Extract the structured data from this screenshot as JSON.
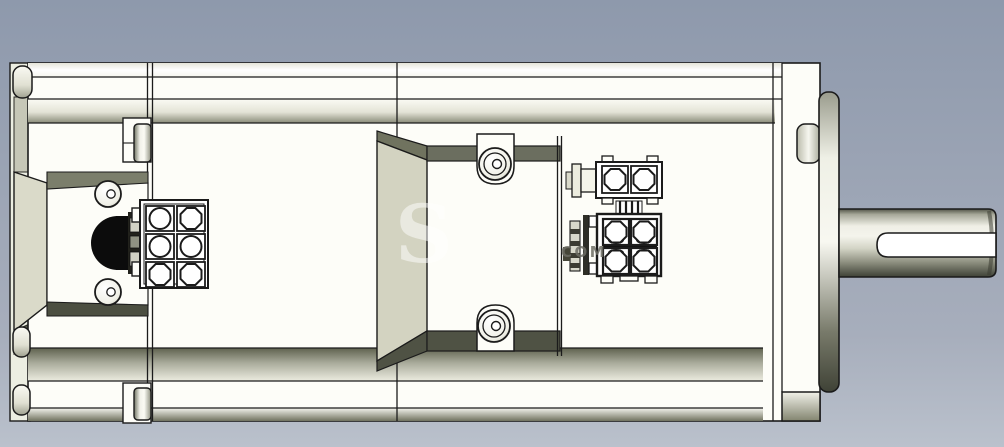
{
  "scene": {
    "kind": "cad-shaded-side-view",
    "subject": "electric servo motor with connectors and keyed output shaft"
  },
  "watermark": {
    "fragment_s": "S",
    "fragment_com": "COM"
  },
  "palette": {
    "background_top": "#8e99ac",
    "background_bottom": "#b9c0cb",
    "body_white": "#fdfdf8",
    "rail_shadow": "#8b8d7b",
    "deep_shadow": "#53564a",
    "recess_panel_beige": "#d3d3c1",
    "outline": "#1b1b1b",
    "grommet_black": "#0c0c0c"
  },
  "parts": [
    "motor-housing",
    "front-bracket-panel",
    "power-connector-6pin",
    "cable-grommet",
    "signal-connector-2pin",
    "signal-connector-4pin",
    "cover-screw-top",
    "cover-screw-bottom",
    "bracket-screw-upper",
    "bracket-screw-lower",
    "cable-clamp-top",
    "cable-clamp-bottom",
    "rear-flange",
    "output-shaft",
    "shaft-keyway"
  ]
}
